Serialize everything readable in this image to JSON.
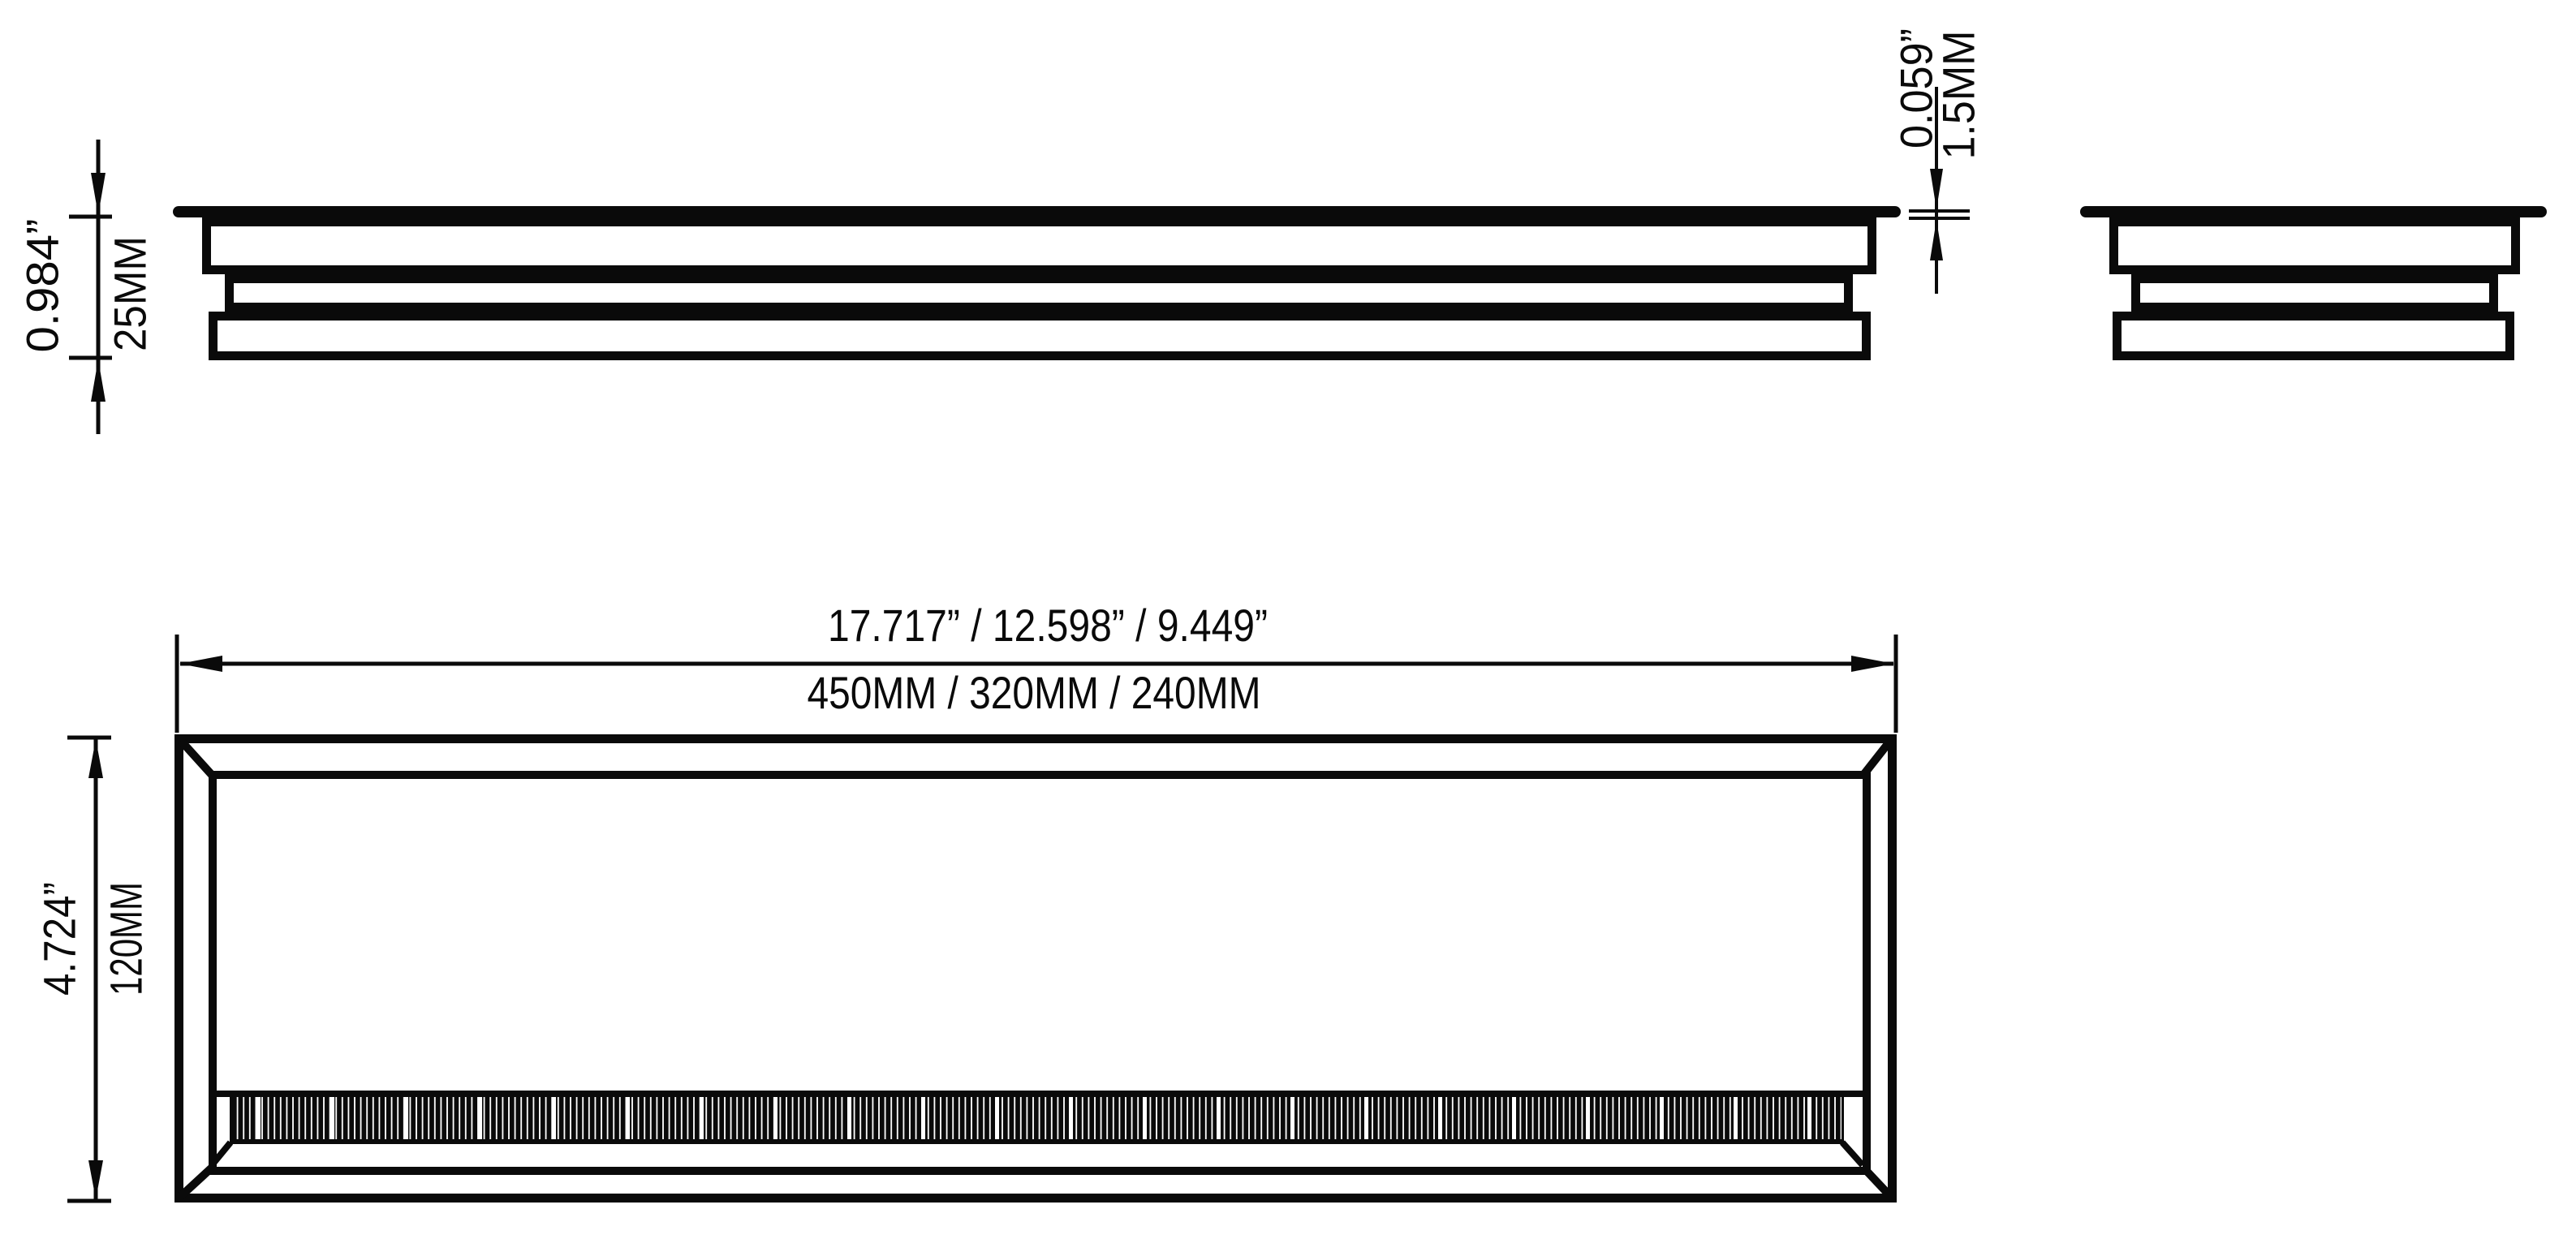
{
  "drawing": {
    "type": "technical-dimension-drawing",
    "subject": "rectangular brush grommet / cable tidy profile, three orthographic views",
    "colors": {
      "ink": "#0a0a0a",
      "background": "#ffffff"
    },
    "views": {
      "side_elevation": "long side profile (top-left)",
      "end_elevation": "short end profile (top-right)",
      "top_plan": "plan view with brush strip (bottom)"
    },
    "dimensions": {
      "profile_height": {
        "inches": "0.984”",
        "mm": "25MM"
      },
      "lid_thickness": {
        "inches": "0.059”",
        "mm": "1.5MM"
      },
      "length_options": {
        "inches": "17.717” / 12.598” / 9.449”",
        "mm": "450MM / 320MM / 240MM"
      },
      "width": {
        "inches": "4.724”",
        "mm": "120MM"
      }
    }
  }
}
